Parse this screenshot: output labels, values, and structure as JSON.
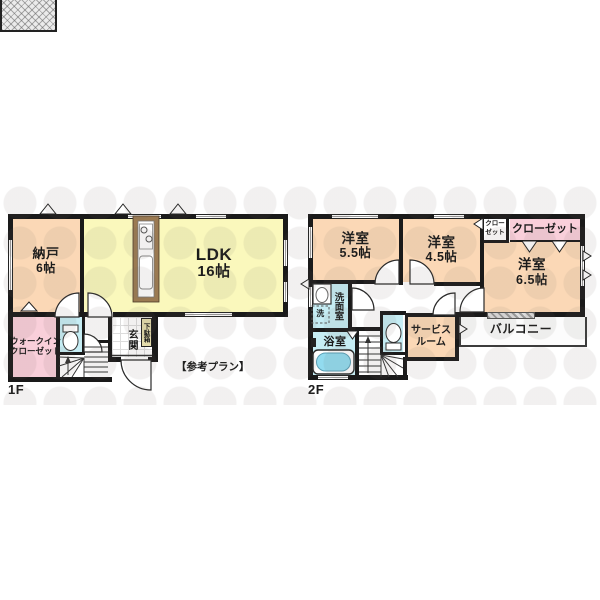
{
  "note": "【参考プラン】",
  "floor1": {
    "label": "1F",
    "nando": {
      "name": "納戸",
      "size": "6帖"
    },
    "ldk": {
      "name": "LDK",
      "size": "16帖"
    },
    "wic": {
      "line1": "ウォークイン",
      "line2": "クローゼット"
    },
    "genkan": {
      "name": "玄関"
    },
    "getabako": {
      "name": "下駄箱"
    }
  },
  "floor2": {
    "label": "2F",
    "bedroom55": {
      "name": "洋室",
      "size": "5.5帖"
    },
    "bedroom45": {
      "name": "洋室",
      "size": "4.5帖"
    },
    "bedroom65": {
      "name": "洋室",
      "size": "6.5帖"
    },
    "closet_small": {
      "line1": "クロー",
      "line2": "ゼット"
    },
    "closet_large": {
      "name": "クローゼット"
    },
    "senmenshitsu": {
      "name": "洗面室"
    },
    "yokushitsu": {
      "name": "浴室"
    },
    "laundry": {
      "name": "洗"
    },
    "service_room": {
      "line1": "サービス",
      "line2": "ルーム"
    },
    "balcony": {
      "name": "バルコニー"
    }
  },
  "colors": {
    "wall": "#1a1a1a",
    "room_peach": "#FBD8B6",
    "room_yellow": "#FAF8BC",
    "room_pink": "#F9CFDA",
    "room_cyan": "#C6EDF4",
    "tub_blue": "#92DBEF",
    "kitchen_brown": "#9b7a52",
    "getabako_tan": "#E4DCAC",
    "watermark": "rgba(105,95,88,0.09)"
  }
}
